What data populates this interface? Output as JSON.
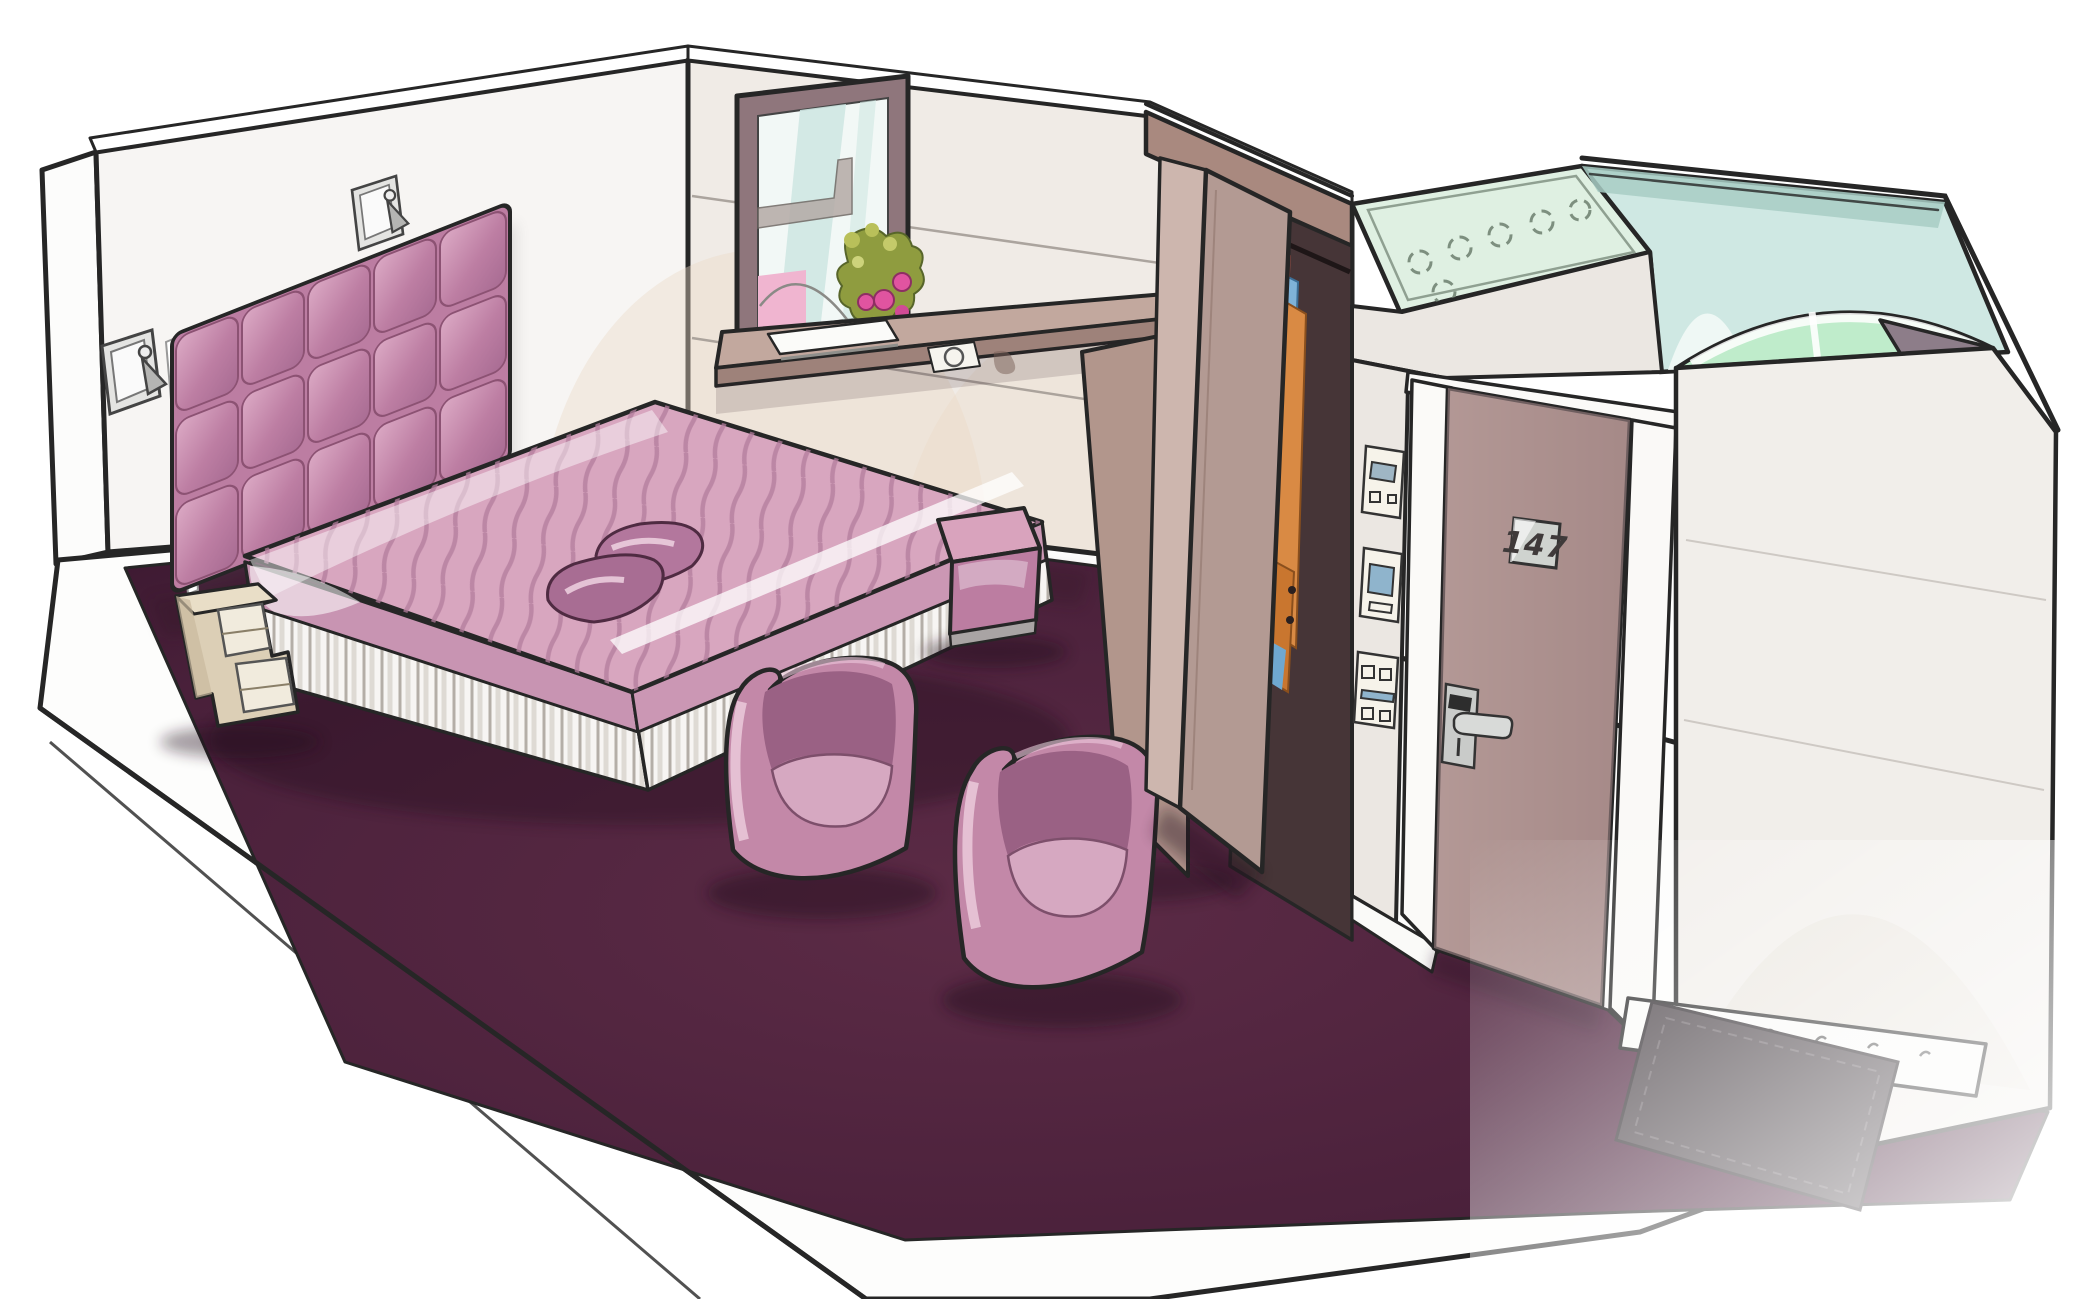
{
  "scene": {
    "kind": "hand-drawn marker illustration",
    "subject": "hotel guest room cutaway perspective sketch",
    "door_number": "147",
    "palette": {
      "outline": "#262626",
      "carpet": "#4d2338",
      "duvet": "#d8a6bf",
      "duvet_stripe": "#b27c9c",
      "duvet_drape": "#c894b2",
      "headboard": "#bc7da2",
      "pillow": "#a86d93",
      "chair": "#c388a8",
      "chair_inner": "#9a6184",
      "chair_seat": "#d6a8c1",
      "pouf_top": "#d9a3bd",
      "pouf_front": "#bc7da1",
      "nightstand": "#dccfb6",
      "desk_top": "#c2a89e",
      "desk_panel": "#b2968c",
      "sill": "#6d595e",
      "wall": "#f0ebe6",
      "head_wall": "#f7f5f3",
      "window_frame": "#8f767c",
      "sky": "#cfe7e3",
      "awning_pink": "#f0b5d0",
      "flower_magenta": "#e054a0",
      "foliage": "#8f9c3f",
      "wardrobe_band": "#a9897f",
      "wardrobe_door": "#b39a93",
      "wardrobe_interior": "#463537",
      "clothes_pink": "#ef9a92",
      "clothes_blue": "#7fb2d8",
      "clothes_orange": "#d98a44",
      "knob_orange": "#eaa24d",
      "corridor_wall": "#ebe7e2",
      "door": "#a98c8e",
      "plaque": "#cfd3cf",
      "handle": "#d8dad8",
      "glass_transom": "#dff0e2",
      "bathroom": "#cfe8e3",
      "bathroom_band": "#a8cdc4",
      "shower_glass": "#bfeccb",
      "dark_wedge": "#8d7d89",
      "right_wall": "#f1eeea",
      "mat": "#4a4247",
      "slab": "#fdfdfc"
    },
    "elements": {
      "bed": "double bed with striped duvet and pleated skirt",
      "headboard": "tufted square-grid headboard",
      "lamps": "two wall-mounted reading spots",
      "nightstand": "zigzag open-cubby bedside unit",
      "window": "window with street view and flower bouquet",
      "desk": "window-side writing ledge with notebook",
      "pouf": "cube pouf",
      "chairs": "two tub armchairs",
      "wardrobe": "open wardrobe with hanging clothes",
      "door": "entry door with number plaque and card lock",
      "bathroom": "bathroom volume with glass transom and lights",
      "mat": "dark entry mat"
    }
  }
}
